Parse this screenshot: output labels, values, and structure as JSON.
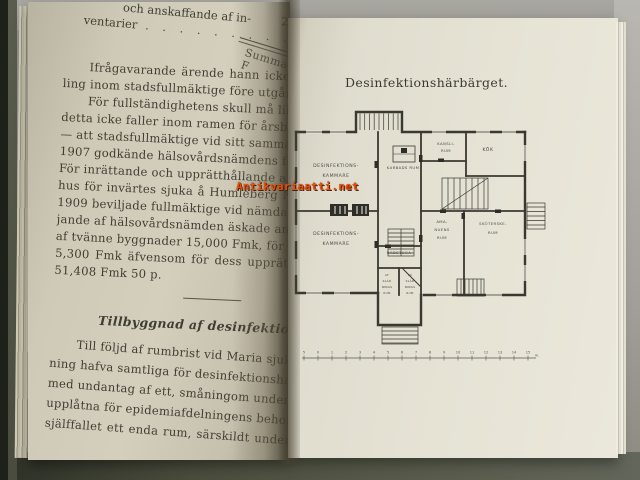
{
  "theme": {
    "watermark_color": "#e8500b",
    "ink": "#3f3d33",
    "plan_ink": "#3a3831"
  },
  "watermark": {
    "text": "Antikvariaatti.net"
  },
  "left_page": {
    "top_fragment": {
      "line1": "och anskaffande af in-",
      "amount": "2,5",
      "item_label": "ventarier",
      "dots": ". . . . . . . . . .",
      "summa": "Summa F"
    },
    "para1": [
      "Ifrågavarande ärende hann icke sp",
      "ling inom stadsfullmäktige före utgången af"
    ],
    "para2": [
      "För fullständighetens skull må likväl nä",
      "detta icke faller inom ramen för årsberättels",
      "— att stadsfullmäktige vid sitt sammanträde",
      "1907 godkände hälsovårdsnämdens förslag i",
      "För inrättande och upprätthållande af ett",
      "hus för invärtes sjuka å Humleberg N:o",
      "1909 beviljade fullmäktige vid nämda sam",
      "jande af hälsovårdsnämden äskade anslag",
      "af tvänne byggnader 15,000 Fmk, för sjuk",
      "5,300 Fmk äfvensom för dess upprätth",
      "51,408 Fmk 50 p."
    ],
    "heading": "Tillbyggnad af desinfektionshärbärget",
    "para3": [
      "Till följd af rumbrist vid Maria sjukh",
      "ning hafva samtliga för desinfektionshärbä",
      "med undantag af ett, småningom under år",
      "upplåtna för epidemiafdelningens behof.",
      "själffallet ett enda rum, särskildt under"
    ]
  },
  "right_page": {
    "title": "Desinfektionshärbärget.",
    "plan": {
      "rooms": {
        "desinfektions_kammare_upper": [
          "DESINFEKTIONS-",
          "KAMMARE"
        ],
        "karbads_rum": [
          "KARBADS RUM"
        ],
        "kansli_rum": [
          "KANSLI-",
          "RUM"
        ],
        "kok": [
          "KÖK"
        ],
        "amanuens_rum": [
          "AMA-",
          "NUENS",
          "RUM"
        ],
        "skoterske_rum": [
          "SKÖTERSKE-",
          "RUM"
        ],
        "desinfektions_kammare_lower": [
          "DESINFEKTIONS-",
          "KAMMARE"
        ],
        "badstuga": [
          "BADSTUGA"
        ],
        "afkladnings_rum": [
          "AF",
          "KLÄD",
          "NINGS",
          "RUM"
        ],
        "pakladnings_rum": [
          "PÅ",
          "KLÄD",
          "NINGS",
          "RUM"
        ]
      },
      "scale": {
        "numbers": [
          "5",
          "0",
          "1",
          "2",
          "3",
          "4",
          "5",
          "6",
          "7",
          "8",
          "9",
          "10",
          "11",
          "12",
          "13",
          "14",
          "15"
        ],
        "unit": "m."
      }
    }
  }
}
